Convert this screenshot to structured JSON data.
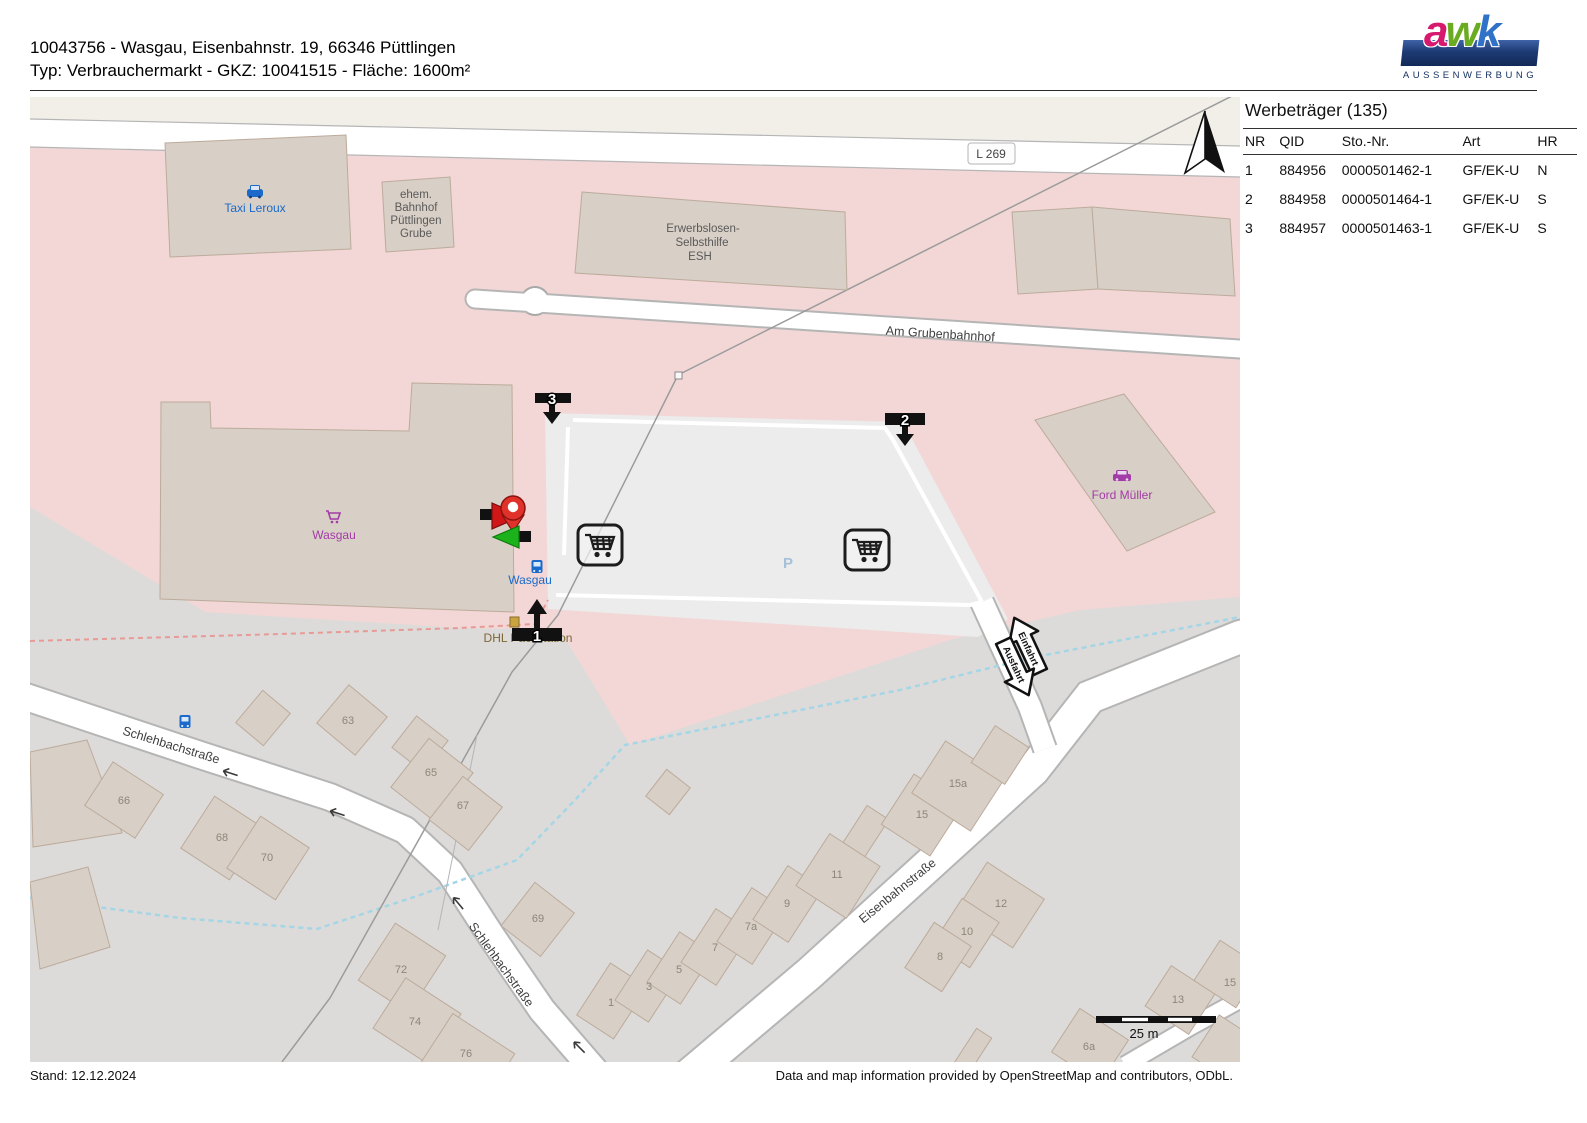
{
  "header": {
    "line1": "10043756 - Wasgau, Eisenbahnstr. 19, 66346 Püttlingen",
    "line2": "Typ: Verbrauchermarkt - GKZ: 10041515 - Fläche: 1600m²"
  },
  "logo": {
    "letters": [
      "a",
      "w",
      "k"
    ],
    "subtitle": "AUSSENWERBUNG"
  },
  "panel": {
    "title": "Werbeträger (135)",
    "columns": [
      "NR",
      "QID",
      "Sto.-Nr.",
      "Art",
      "HR"
    ],
    "rows": [
      [
        "1",
        "884956",
        "0000501462-1",
        "GF/EK-U",
        "N"
      ],
      [
        "2",
        "884958",
        "0000501464-1",
        "GF/EK-U",
        "S"
      ],
      [
        "3",
        "884957",
        "0000501463-1",
        "GF/EK-U",
        "S"
      ]
    ]
  },
  "map": {
    "roads": {
      "l269": "L 269",
      "grubenbahnhof": "Am Grubenbahnhof",
      "schlehbach": "Schlehbachstraße",
      "eisenbahn": "Eisenbahnstraße"
    },
    "pois": {
      "taxi": "Taxi Leroux",
      "bahnhof": [
        "ehem.",
        "Bahnhof",
        "Püttlingen",
        "Grube"
      ],
      "esh": [
        "Erwerbslosen-",
        "Selbsthilfe",
        "ESH"
      ],
      "wasgau_shop": "Wasgau",
      "wasgau_stop": "Wasgau",
      "ford": "Ford Müller",
      "dhl": "DHL Packstation",
      "parking": "P"
    },
    "markers": {
      "m1": "1",
      "m2": "2",
      "m3": "3"
    },
    "access": {
      "in": "Einfahrt",
      "out": "Ausfahrt"
    },
    "scale": "25 m",
    "housenumbers": [
      "63",
      "65",
      "67",
      "66",
      "68",
      "70",
      "69",
      "72",
      "74",
      "76",
      "1",
      "3",
      "5",
      "7",
      "7a",
      "9",
      "11",
      "15a",
      "15",
      "12",
      "10",
      "8",
      "6a",
      "13",
      "15"
    ]
  },
  "footer": {
    "left": "Stand: 12.12.2024",
    "right": "Data and map information provided by OpenStreetMap and contributors, ODbL."
  },
  "colors": {
    "retail_pink": "#f2d7d6",
    "residential_gray": "#dcdbd9",
    "building": "#d8cfc6",
    "poi_blue": "#1b6acb",
    "shop_purple": "#a23ca6",
    "brand_navy": "#16305e"
  }
}
